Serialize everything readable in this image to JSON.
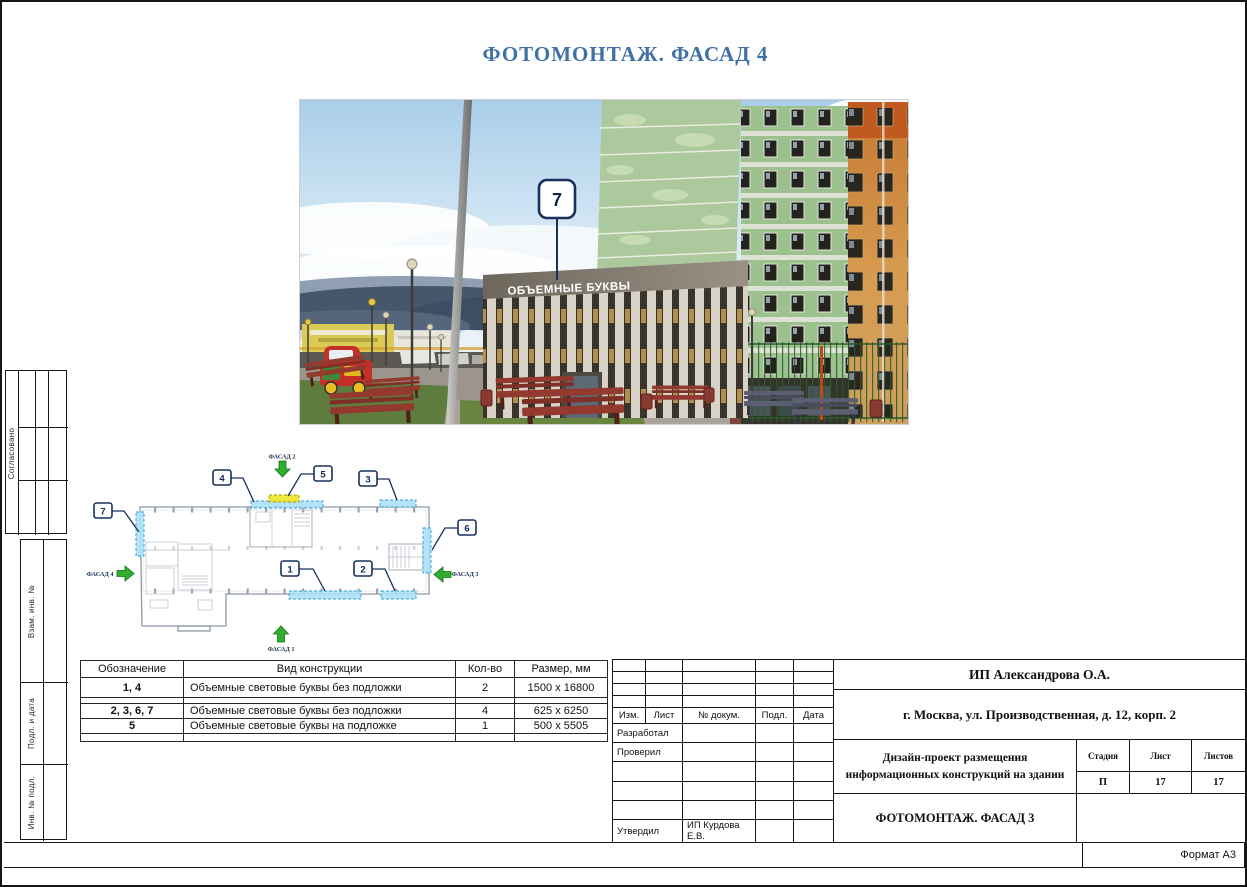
{
  "page": {
    "title": "ФОТОМОНТАЖ. ФАСАД 4",
    "format": "Формат А3"
  },
  "colors": {
    "accent_blue": "#3f70a6",
    "callout_navy": "#16305e",
    "arrow_green": "#2fae2f",
    "highlight_blue": "#ade0f6",
    "highlight_yellow": "#f0e428"
  },
  "photo": {
    "sign": "ОБЪЕМНЫЕ БУКВЫ",
    "callout": "7"
  },
  "plan": {
    "callouts": {
      "c1": "1",
      "c2": "2",
      "c3": "3",
      "c4": "4",
      "c5": "5",
      "c6": "6",
      "c7": "7"
    },
    "facades": {
      "f1": "ФАСАД 1",
      "f2": "ФАСАД 2",
      "f3": "ФАСАД 3",
      "f4": "ФАСАД 4"
    }
  },
  "materials_table": {
    "headers": [
      "Обозначение",
      "Вид конструкции",
      "Кол-во",
      "Размер, мм"
    ],
    "rows": [
      {
        "mark": "1, 4",
        "type": "Объемные световые буквы без подложки",
        "qty": "2",
        "size": "1500 x 16800"
      },
      {
        "mark": "2, 3, 6, 7",
        "type": "Объемные световые буквы без подложки",
        "qty": "4",
        "size": "625 x 6250"
      },
      {
        "mark": "5",
        "type": "Объемные световые буквы на подложке",
        "qty": "1",
        "size": "500 x 5505"
      }
    ]
  },
  "title_block": {
    "company": "ИП Александрова О.А.",
    "address": "г. Москва, ул. Производственная, д. 12, корп. 2",
    "project_line1": "Дизайн-проект размещения",
    "project_line2": "информационных конструкций на здании",
    "sheet_title": "ФОТОМОНТАЖ. ФАСАД 3",
    "stage_label": "Стадия",
    "stage": "П",
    "sheet_label": "Лист",
    "sheet_no": "17",
    "sheets_label": "Листов",
    "sheets_total": "17",
    "cols": [
      "Изм.",
      "Лист",
      "№ докум.",
      "Подл.",
      "Дата"
    ],
    "developed": "Разработал",
    "checked": "Проверил",
    "approved": "Утвердил",
    "approved_by": "ИП Курдова Е.В."
  },
  "sidebar": {
    "agreed": "Согласовано",
    "vzam": "Взам. инв. №",
    "podp": "Подл. и дата",
    "inv": "Инв. № подл."
  }
}
